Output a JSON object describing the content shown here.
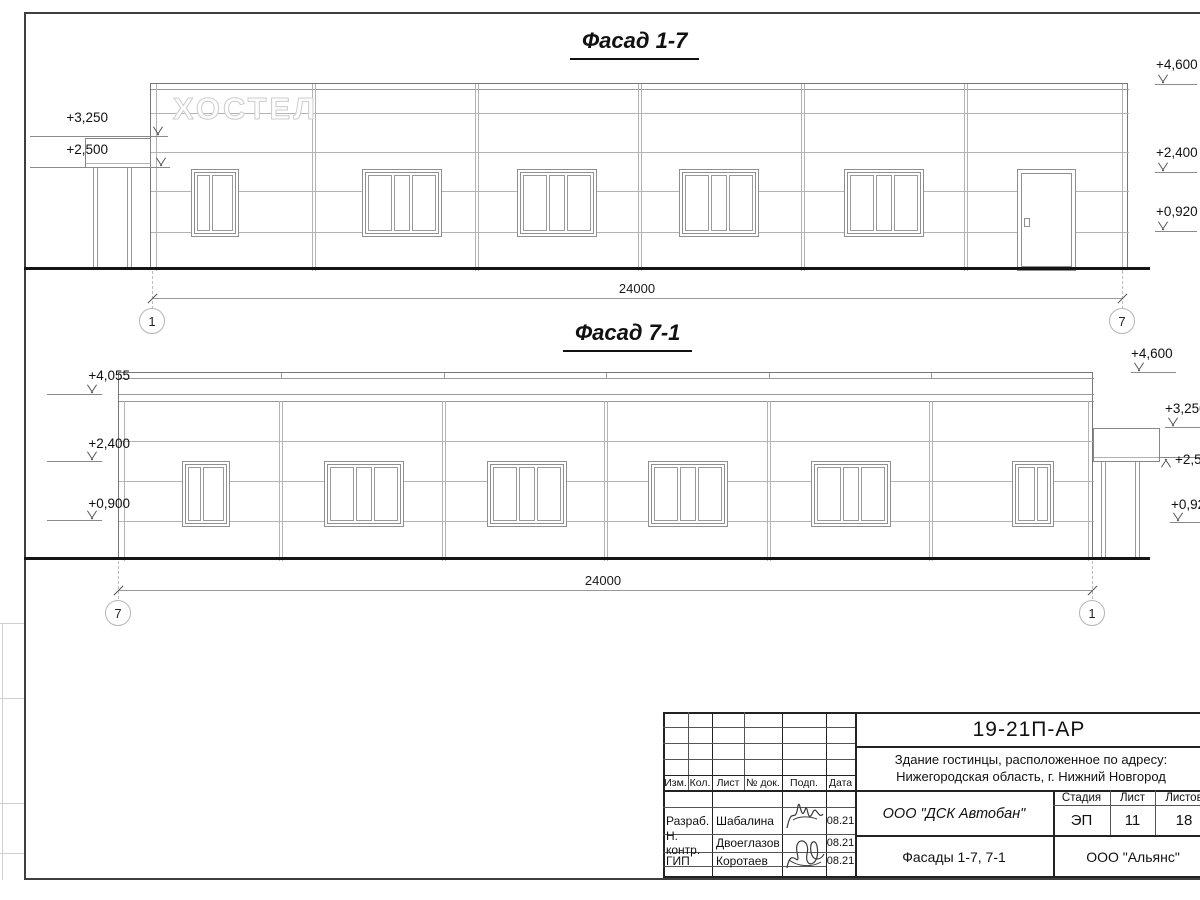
{
  "facade_top": {
    "title": "Фасад 1-7",
    "sign_text": "ХОСТЕЛ",
    "dim_label": "24000",
    "axis_left": "1",
    "axis_right": "7",
    "marks_left": {
      "m1": "+3,250",
      "m2": "+2,500"
    },
    "marks_right": {
      "m1": "+4,600",
      "m2": "+2,400",
      "m3": "+0,920"
    }
  },
  "facade_bottom": {
    "title": "Фасад 7-1",
    "dim_label": "24000",
    "axis_left": "7",
    "axis_right": "1",
    "marks_left": {
      "m1": "+4,055",
      "m2": "+2,400",
      "m3": "+0,900"
    },
    "marks_right": {
      "m1": "+4,600",
      "m2": "+3,250",
      "m3": "+2,500",
      "m4": "+0,920"
    }
  },
  "titleblock": {
    "doc_code": "19-21П-АР",
    "project_line1": "Здание гостинцы, расположенное по адресу:",
    "project_line2": "Нижегородская область, г. Нижний Новгород",
    "col_izm": "Изм.",
    "col_kol": "Кол.",
    "col_list": "Лист",
    "col_doc": "№ док.",
    "col_sign": "Подп.",
    "col_date": "Дата",
    "row1_role": "Разраб.",
    "row1_name": "Шабалина",
    "row1_date": "08.21",
    "row2_role": "Н. контр.",
    "row2_name": "Двоеглазов",
    "row2_date": "08.21",
    "row3_role": "ГИП",
    "row3_name": "Коротаев",
    "row3_date": "08.21",
    "company": "ООО \"ДСК Автобан\"",
    "stage_label": "Стадия",
    "sheet_label": "Лист",
    "sheets_label": "Листов",
    "stage_value": "ЭП",
    "sheet_value": "11",
    "sheets_value": "18",
    "drawing_title": "Фасады 1-7, 7-1",
    "contractor": "ООО \"Альянс\""
  }
}
